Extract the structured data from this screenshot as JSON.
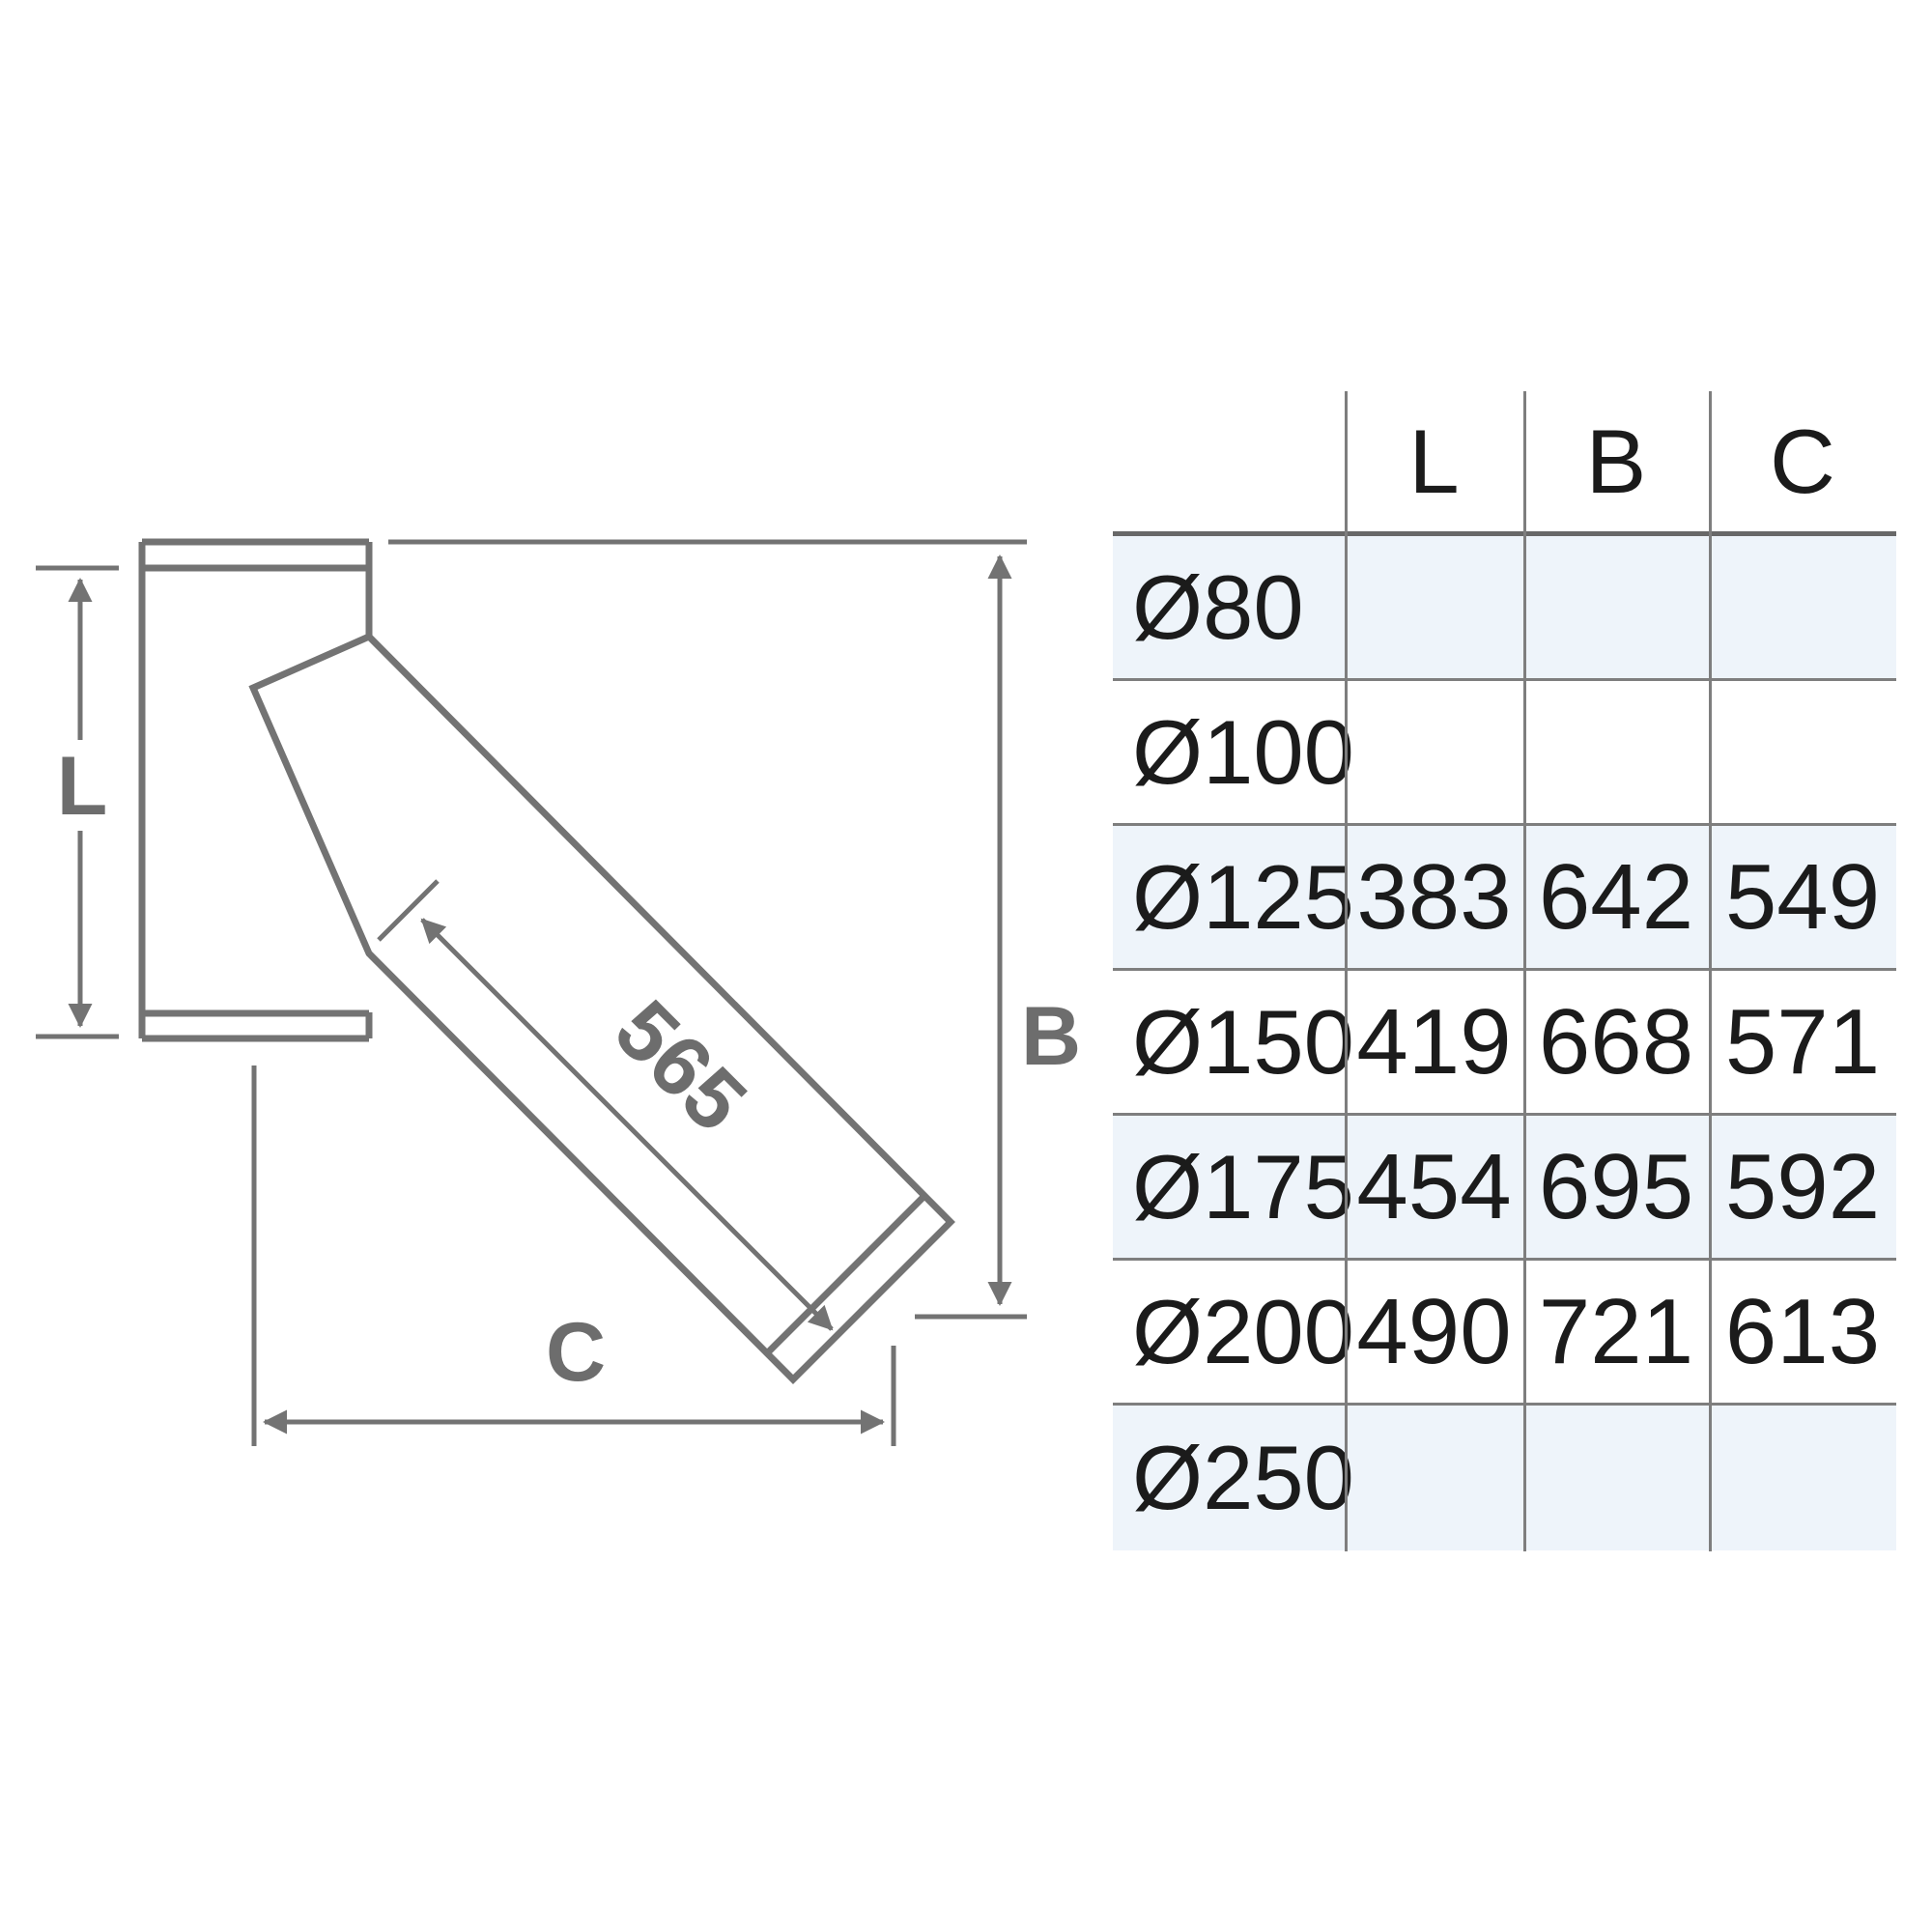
{
  "diagram": {
    "labels": {
      "l": "L",
      "b": "B",
      "c": "C",
      "branch_length": "565"
    },
    "colors": {
      "line": "#737373",
      "label": "#6d6d6d"
    }
  },
  "table": {
    "headers": [
      "L",
      "B",
      "C"
    ],
    "rows": [
      {
        "label": "Ø80",
        "l": "",
        "b": "",
        "c": "",
        "shaded": true
      },
      {
        "label": "Ø100",
        "l": "",
        "b": "",
        "c": "",
        "shaded": false
      },
      {
        "label": "Ø125",
        "l": "383",
        "b": "642",
        "c": "549",
        "shaded": true
      },
      {
        "label": "Ø150",
        "l": "419",
        "b": "668",
        "c": "571",
        "shaded": false
      },
      {
        "label": "Ø175",
        "l": "454",
        "b": "695",
        "c": "592",
        "shaded": true
      },
      {
        "label": "Ø200",
        "l": "490",
        "b": "721",
        "c": "613",
        "shaded": false
      },
      {
        "label": "Ø250",
        "l": "",
        "b": "",
        "c": "",
        "shaded": true
      }
    ],
    "colors": {
      "shaded_row_bg": "#eef4fa",
      "grid_line": "#7e7e7e",
      "header_line": "#686868",
      "text": "#1b1b1b"
    }
  }
}
